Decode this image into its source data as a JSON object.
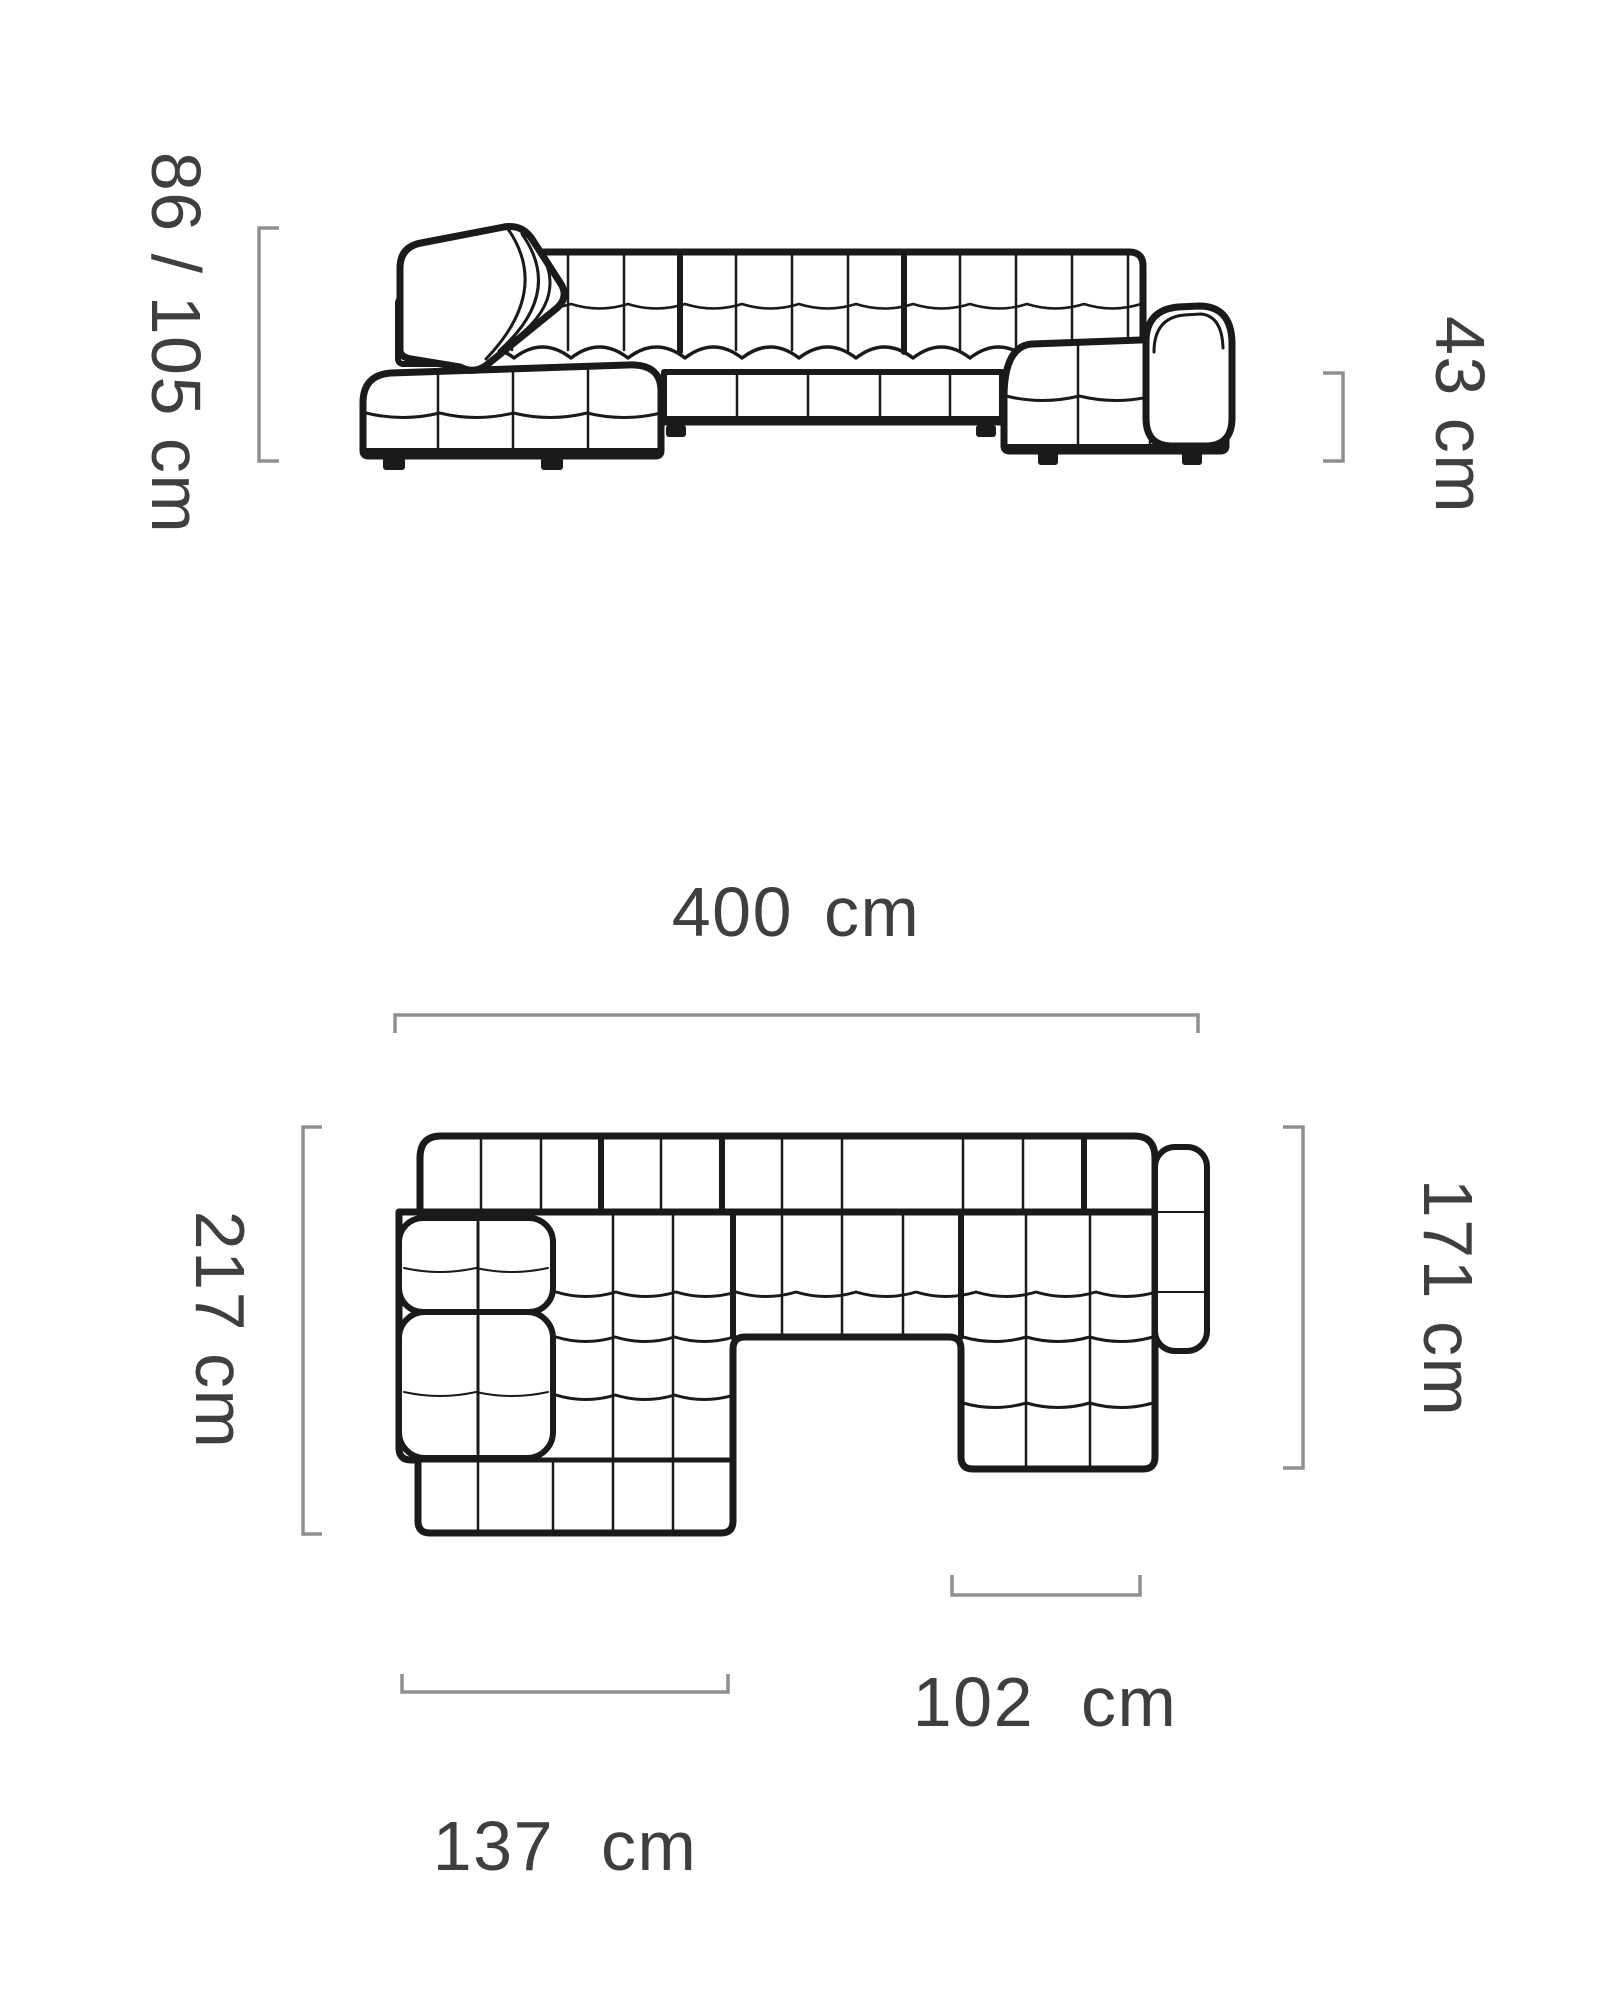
{
  "figure": {
    "type": "furniture-dimension-diagram",
    "subject": "corner-sectional-sofa",
    "views": {
      "front": {
        "height": "86 / 105 cm",
        "seat_height": "43 cm"
      },
      "top": {
        "total_width": "400 cm",
        "depth_left": "217 cm",
        "depth_right": "171 cm",
        "left_chaise_width": "137 cm",
        "right_chaise_width": "102 cm"
      }
    },
    "measurements": {
      "height_min_cm": 86,
      "height_max_cm": 105,
      "seat_height_cm": 43,
      "total_width_cm": 400,
      "depth_left_cm": 217,
      "depth_right_cm": 171,
      "left_chaise_width_cm": 137,
      "right_chaise_width_cm": 102,
      "unit": "cm"
    },
    "colors": {
      "line": "#1a1a1a",
      "bracket": "#8f8f8f",
      "text": "#3f3f3f",
      "background": "#ffffff"
    }
  }
}
